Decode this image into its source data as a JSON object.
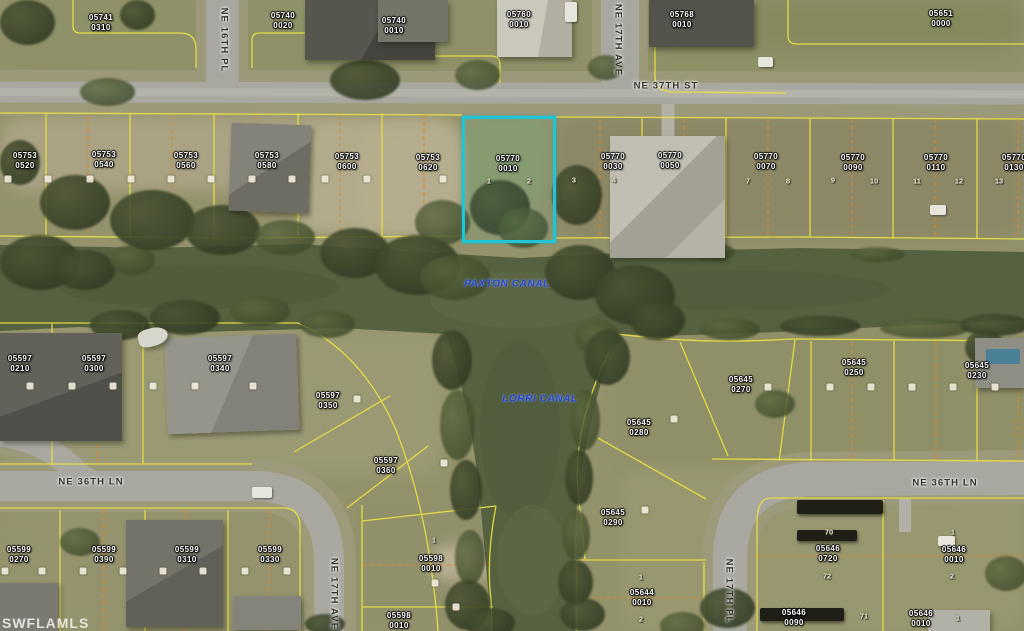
{
  "watermark": "SWFLAMLS",
  "colors": {
    "highlight_outline": "#1fc6d8",
    "parcel_line": "#e8e042",
    "interior_lot_line": "#d9882b",
    "canal_text": "#2345cf",
    "water": "#566140"
  },
  "highlighted_parcel": {
    "block": "05770",
    "lot": "0010"
  },
  "canal_labels": [
    {
      "name": "PAXTON CANAL",
      "x": 507,
      "y": 284
    },
    {
      "name": "LORRI CANAL",
      "x": 540,
      "y": 399
    }
  ],
  "street_labels": [
    {
      "name": "NE 16TH PL",
      "x": 224,
      "y": 40,
      "vertical": true
    },
    {
      "name": "NE 17TH AVE",
      "x": 618,
      "y": 40,
      "vertical": true
    },
    {
      "name": "NE 37TH ST",
      "x": 666,
      "y": 86,
      "vertical": false
    },
    {
      "name": "NE 36TH LN",
      "x": 91,
      "y": 482,
      "vertical": false
    },
    {
      "name": "NE 36TH LN",
      "x": 945,
      "y": 483,
      "vertical": false
    },
    {
      "name": "NE 17TH AVE",
      "x": 334,
      "y": 594,
      "vertical": true
    },
    {
      "name": "NE 17TH PL",
      "x": 729,
      "y": 591,
      "vertical": true
    }
  ],
  "parcel_labels": [
    {
      "block": "05741",
      "lot": "0310",
      "x": 101,
      "y": 23
    },
    {
      "block": "05740",
      "lot": "0020",
      "x": 283,
      "y": 21
    },
    {
      "block": "05740",
      "lot": "0010",
      "x": 394,
      "y": 26
    },
    {
      "block": "05760",
      "lot": "0010",
      "x": 519,
      "y": 20
    },
    {
      "block": "05768",
      "lot": "0010",
      "x": 682,
      "y": 20
    },
    {
      "block": "05651",
      "lot": "0000",
      "x": 941,
      "y": 19
    },
    {
      "block": "05753",
      "lot": "0520",
      "x": 25,
      "y": 161
    },
    {
      "block": "05753",
      "lot": "0540",
      "x": 104,
      "y": 160
    },
    {
      "block": "05753",
      "lot": "0560",
      "x": 186,
      "y": 161
    },
    {
      "block": "05753",
      "lot": "0580",
      "x": 267,
      "y": 161
    },
    {
      "block": "05753",
      "lot": "0600",
      "x": 347,
      "y": 162
    },
    {
      "block": "05753",
      "lot": "0620",
      "x": 428,
      "y": 163
    },
    {
      "block": "05770",
      "lot": "0010",
      "x": 508,
      "y": 164
    },
    {
      "block": "05770",
      "lot": "0030",
      "x": 613,
      "y": 162
    },
    {
      "block": "05770",
      "lot": "0050",
      "x": 670,
      "y": 161
    },
    {
      "block": "05770",
      "lot": "0070",
      "x": 766,
      "y": 162
    },
    {
      "block": "05770",
      "lot": "0090",
      "x": 853,
      "y": 163
    },
    {
      "block": "05770",
      "lot": "0110",
      "x": 936,
      "y": 163
    },
    {
      "block": "05770",
      "lot": "0130",
      "x": 1014,
      "y": 163
    },
    {
      "block": "05597",
      "lot": "0210",
      "x": 20,
      "y": 364
    },
    {
      "block": "05597",
      "lot": "0300",
      "x": 94,
      "y": 364
    },
    {
      "block": "05597",
      "lot": "0340",
      "x": 220,
      "y": 364
    },
    {
      "block": "05597",
      "lot": "0350",
      "x": 328,
      "y": 401
    },
    {
      "block": "05597",
      "lot": "0360",
      "x": 386,
      "y": 466
    },
    {
      "block": "05599",
      "lot": "0270",
      "x": 19,
      "y": 555
    },
    {
      "block": "05599",
      "lot": "0390",
      "x": 104,
      "y": 555
    },
    {
      "block": "05599",
      "lot": "0310",
      "x": 187,
      "y": 555
    },
    {
      "block": "05599",
      "lot": "0330",
      "x": 270,
      "y": 555
    },
    {
      "block": "05598",
      "lot": "0010",
      "x": 431,
      "y": 564
    },
    {
      "block": "05598",
      "lot": "0010",
      "x": 399,
      "y": 621
    },
    {
      "block": "05644",
      "lot": "0010",
      "x": 642,
      "y": 598
    },
    {
      "block": "05645",
      "lot": "0280",
      "x": 639,
      "y": 428
    },
    {
      "block": "05645",
      "lot": "0290",
      "x": 613,
      "y": 518
    },
    {
      "block": "05645",
      "lot": "0270",
      "x": 741,
      "y": 385
    },
    {
      "block": "05645",
      "lot": "0250",
      "x": 854,
      "y": 368
    },
    {
      "block": "05645",
      "lot": "0230",
      "x": 977,
      "y": 371
    },
    {
      "block": "05646",
      "lot": "0720",
      "x": 828,
      "y": 554
    },
    {
      "block": "05646",
      "lot": "0010",
      "x": 954,
      "y": 555
    },
    {
      "block": "05646",
      "lot": "0090",
      "x": 794,
      "y": 618
    },
    {
      "block": "05646",
      "lot": "0010",
      "x": 921,
      "y": 619
    }
  ],
  "lot_markers": [
    {
      "n": "1",
      "x": 489,
      "y": 181
    },
    {
      "n": "2",
      "x": 529,
      "y": 181
    },
    {
      "n": "3",
      "x": 574,
      "y": 180
    },
    {
      "n": "4",
      "x": 614,
      "y": 180
    },
    {
      "n": "7",
      "x": 748,
      "y": 181
    },
    {
      "n": "8",
      "x": 788,
      "y": 181
    },
    {
      "n": "9",
      "x": 833,
      "y": 180
    },
    {
      "n": "10",
      "x": 874,
      "y": 181
    },
    {
      "n": "11",
      "x": 917,
      "y": 181
    },
    {
      "n": "12",
      "x": 959,
      "y": 181
    },
    {
      "n": "13",
      "x": 999,
      "y": 181
    },
    {
      "n": "70",
      "x": 829,
      "y": 532
    },
    {
      "n": "72",
      "x": 827,
      "y": 576
    },
    {
      "n": "1",
      "x": 953,
      "y": 532
    },
    {
      "n": "2",
      "x": 952,
      "y": 576
    },
    {
      "n": "71",
      "x": 864,
      "y": 616
    },
    {
      "n": "1",
      "x": 958,
      "y": 618
    },
    {
      "n": "1",
      "x": 641,
      "y": 577
    },
    {
      "n": "2",
      "x": 641,
      "y": 619
    },
    {
      "n": "1",
      "x": 434,
      "y": 540
    }
  ],
  "unreadable_markers": [
    {
      "x": 8,
      "y": 179
    },
    {
      "x": 48,
      "y": 179
    },
    {
      "x": 90,
      "y": 179
    },
    {
      "x": 131,
      "y": 179
    },
    {
      "x": 171,
      "y": 179
    },
    {
      "x": 211,
      "y": 179
    },
    {
      "x": 252,
      "y": 179
    },
    {
      "x": 292,
      "y": 179
    },
    {
      "x": 325,
      "y": 179
    },
    {
      "x": 367,
      "y": 179
    },
    {
      "x": 443,
      "y": 179
    },
    {
      "x": 30,
      "y": 386
    },
    {
      "x": 72,
      "y": 386
    },
    {
      "x": 113,
      "y": 386
    },
    {
      "x": 153,
      "y": 386
    },
    {
      "x": 195,
      "y": 386
    },
    {
      "x": 253,
      "y": 386
    },
    {
      "x": 357,
      "y": 399
    },
    {
      "x": 444,
      "y": 463
    },
    {
      "x": 5,
      "y": 571
    },
    {
      "x": 42,
      "y": 571
    },
    {
      "x": 83,
      "y": 571
    },
    {
      "x": 123,
      "y": 571
    },
    {
      "x": 163,
      "y": 571
    },
    {
      "x": 203,
      "y": 571
    },
    {
      "x": 245,
      "y": 571
    },
    {
      "x": 287,
      "y": 571
    },
    {
      "x": 768,
      "y": 387
    },
    {
      "x": 830,
      "y": 387
    },
    {
      "x": 871,
      "y": 387
    },
    {
      "x": 912,
      "y": 387
    },
    {
      "x": 953,
      "y": 387
    },
    {
      "x": 995,
      "y": 387
    },
    {
      "x": 674,
      "y": 419
    },
    {
      "x": 645,
      "y": 510
    },
    {
      "x": 435,
      "y": 583
    },
    {
      "x": 456,
      "y": 607
    }
  ]
}
